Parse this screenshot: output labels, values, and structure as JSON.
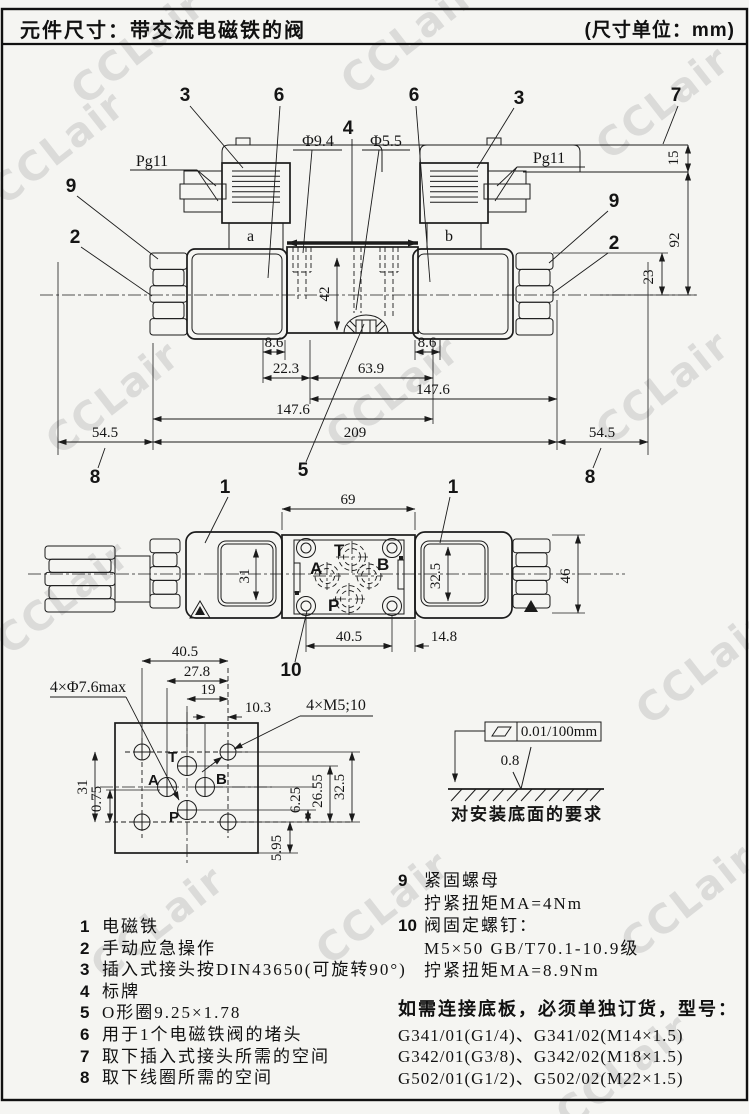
{
  "header": {
    "title": "元件尺寸：带交流电磁铁的阀",
    "unit": "(尺寸单位：mm)"
  },
  "watermark": {
    "text": "CCLair"
  },
  "front_view": {
    "pg11_left": "Pg11",
    "pg11_right": "Pg11",
    "coil_a": "a",
    "coil_b": "b",
    "dia_large": "Φ9.4",
    "dia_small": "Φ5.5",
    "callouts": {
      "n3l": "3",
      "n6l": "6",
      "n6r": "6",
      "n3r": "3",
      "n7": "7",
      "n9l": "9",
      "n2l": "2",
      "n9r": "9",
      "n2r": "2",
      "n4": "4",
      "n5": "5",
      "n8l": "8",
      "n8r": "8"
    },
    "dims": {
      "d86l": "8.6",
      "d86r": "8.6",
      "d223": "22.3",
      "d639": "63.9",
      "d1476r": "147.6",
      "d1476l": "147.6",
      "d209": "209",
      "d545l": "54.5",
      "d545r": "54.5",
      "d15": "15",
      "d92": "92",
      "d23": "23",
      "d42": "42"
    }
  },
  "top_view": {
    "callouts": {
      "n1l": "1",
      "n1r": "1",
      "n10": "10"
    },
    "ports": {
      "t": "T",
      "a": "A",
      "b": "B",
      "p": "P"
    },
    "dims": {
      "d69": "69",
      "d31": "31",
      "d325": "32.5",
      "d46": "46",
      "d405": "40.5",
      "d148": "14.8"
    }
  },
  "bottom_view": {
    "holes_label": "4×Φ7.6max",
    "screws_label": "4×M5;10",
    "ports": {
      "t": "T",
      "a": "A",
      "b": "B",
      "p": "P"
    },
    "dims": {
      "d405": "40.5",
      "d278": "27.8",
      "d19": "19",
      "d103": "10.3",
      "d31": "31",
      "d075": "0.75",
      "d625": "6.25",
      "d2655": "26.55",
      "d325": "32.5",
      "d595": "5.95"
    }
  },
  "surface_req": {
    "flatness": "0.01/100mm",
    "roughness": "0.8",
    "caption": "对安装底面的要求"
  },
  "notes_left": [
    {
      "num": "1",
      "text": "电磁铁"
    },
    {
      "num": "2",
      "text": "手动应急操作"
    },
    {
      "num": "3",
      "text": "插入式接头按DIN43650(可旋转90°)"
    },
    {
      "num": "4",
      "text": "标牌"
    },
    {
      "num": "5",
      "text": "O形圈9.25×1.78"
    },
    {
      "num": "6",
      "text": "用于1个电磁铁阀的堵头"
    },
    {
      "num": "7",
      "text": "取下插入式接头所需的空间"
    },
    {
      "num": "8",
      "text": "取下线圈所需的空间"
    }
  ],
  "notes_right": {
    "n9": "9",
    "t9": "紧固螺母",
    "t9_torque": "拧紧扭矩MA=4Nm",
    "n10": "10",
    "t10": "阀固定螺钉：",
    "t10_spec": "M5×50 GB/T70.1-10.9级",
    "t10_torque": "拧紧扭矩MA=8.9Nm"
  },
  "order_note": {
    "title": "如需连接底板，必须单独订货，型号：",
    "lines": [
      "G341/01(G1/4)、G341/02(M14×1.5)",
      "G342/01(G3/8)、G342/02(M18×1.5)",
      "G502/01(G1/2)、G502/02(M22×1.5)"
    ]
  }
}
